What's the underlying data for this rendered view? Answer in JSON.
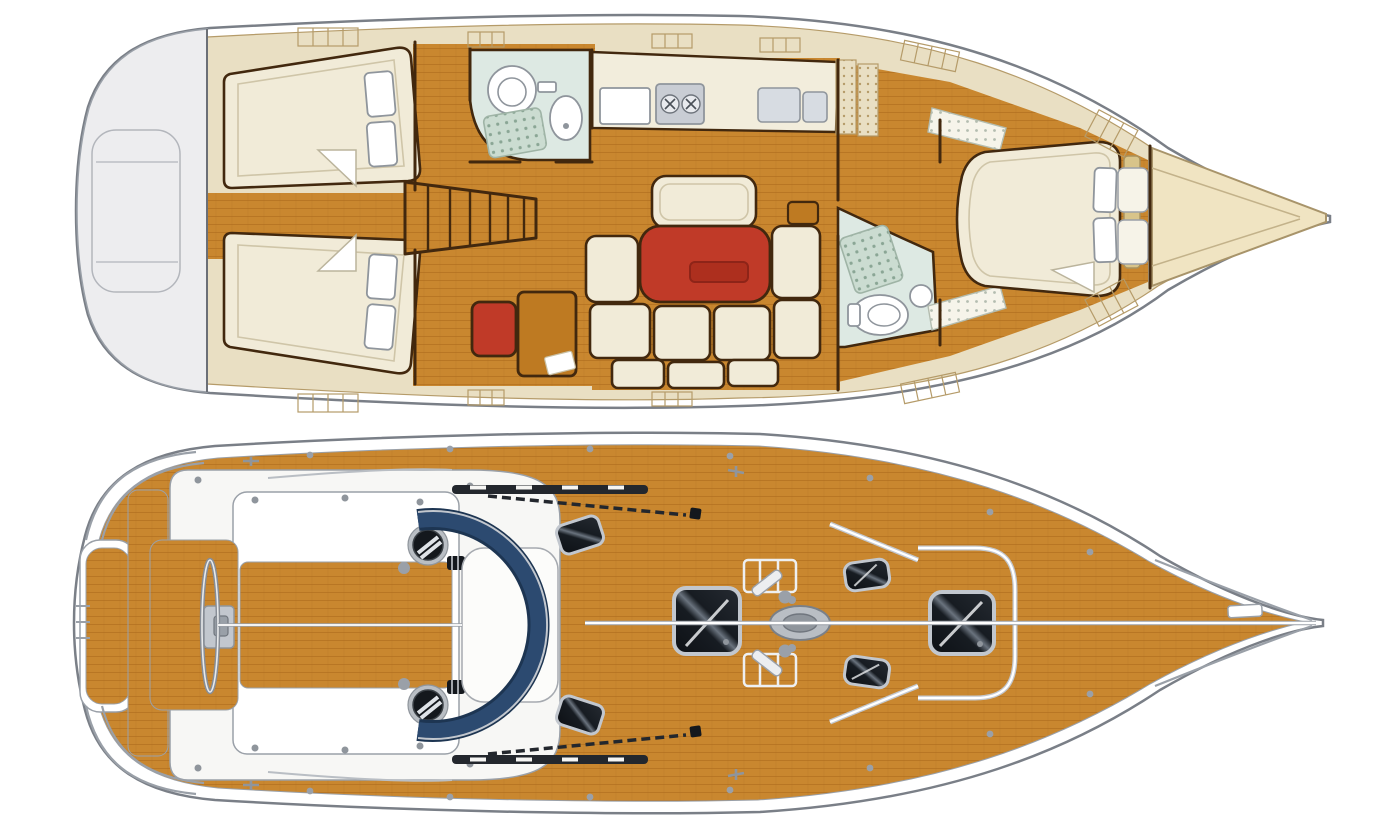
{
  "diagram": {
    "type": "yacht-layout",
    "views": [
      {
        "id": "interior-plan",
        "name": "interior accommodation plan",
        "position": "top"
      },
      {
        "id": "deck-plan",
        "name": "deck plan",
        "position": "bottom"
      }
    ]
  },
  "palette": {
    "teak": "#C9872F",
    "teak-line": "#A8661A",
    "cream": "#F1EBD8",
    "cream-line": "#CFC5A8",
    "beige": "#E9DFC3",
    "beige-line": "#B59B69",
    "wall": "#42280E",
    "wood-mid": "#BE7A22",
    "red": "#C03A28",
    "red-dark": "#8E2418",
    "navy": "#2C4A70",
    "pale-blue": "#DDE9E3",
    "grate": "#CBDCD1",
    "grate-dot": "#8AA695",
    "hull-line": "#7A7F87",
    "metal": "#C2C7CE",
    "metal-mid": "#9AA0A8",
    "metal-dark": "#8F959C",
    "hatch": "#171B21",
    "gray-deck": "#EDEDEF",
    "deck-white": "#F7F7F5",
    "bow-fill": "#F0E4C2",
    "bow-line": "#A8946A",
    "tan-headboard": "#D8C48A"
  },
  "interior_features": [
    "transom-swim-platform",
    "aft-cabin-port-berth",
    "aft-cabin-starboard-berth",
    "companionway-steps",
    "head-port-toilet",
    "head-port-sink",
    "head-port-shower-grate",
    "galley-stove",
    "galley-sink",
    "galley-vent-lockers",
    "salon-table",
    "salon-settee",
    "nav-station-seat",
    "nav-chart-table",
    "head-forward-shower-grate",
    "head-forward-toilet",
    "head-forward-sink",
    "forward-cabin-island-berth",
    "forward-cabin-pillows",
    "forward-cabin-shelves",
    "wardrobe",
    "anchor-locker-bow"
  ],
  "deck_features": [
    "swim-platform",
    "pushpit-rail",
    "helm-seat",
    "steering-wheel",
    "helm-pedestal",
    "cockpit-benches",
    "cockpit-teak-sole",
    "primary-winch-port",
    "primary-winch-starboard",
    "rope-clutches",
    "sprayhood",
    "companionway-hatch",
    "grab-rails",
    "genoa-track",
    "coachroof-hatches",
    "saloon-skylight",
    "halyard-winch-handles",
    "mast-base",
    "deck-hatches",
    "anchor-locker",
    "forward-hatch",
    "bow-pulpit",
    "anchor-roller",
    "stanchions",
    "midship-cleats",
    "toe-rail-centerline"
  ]
}
